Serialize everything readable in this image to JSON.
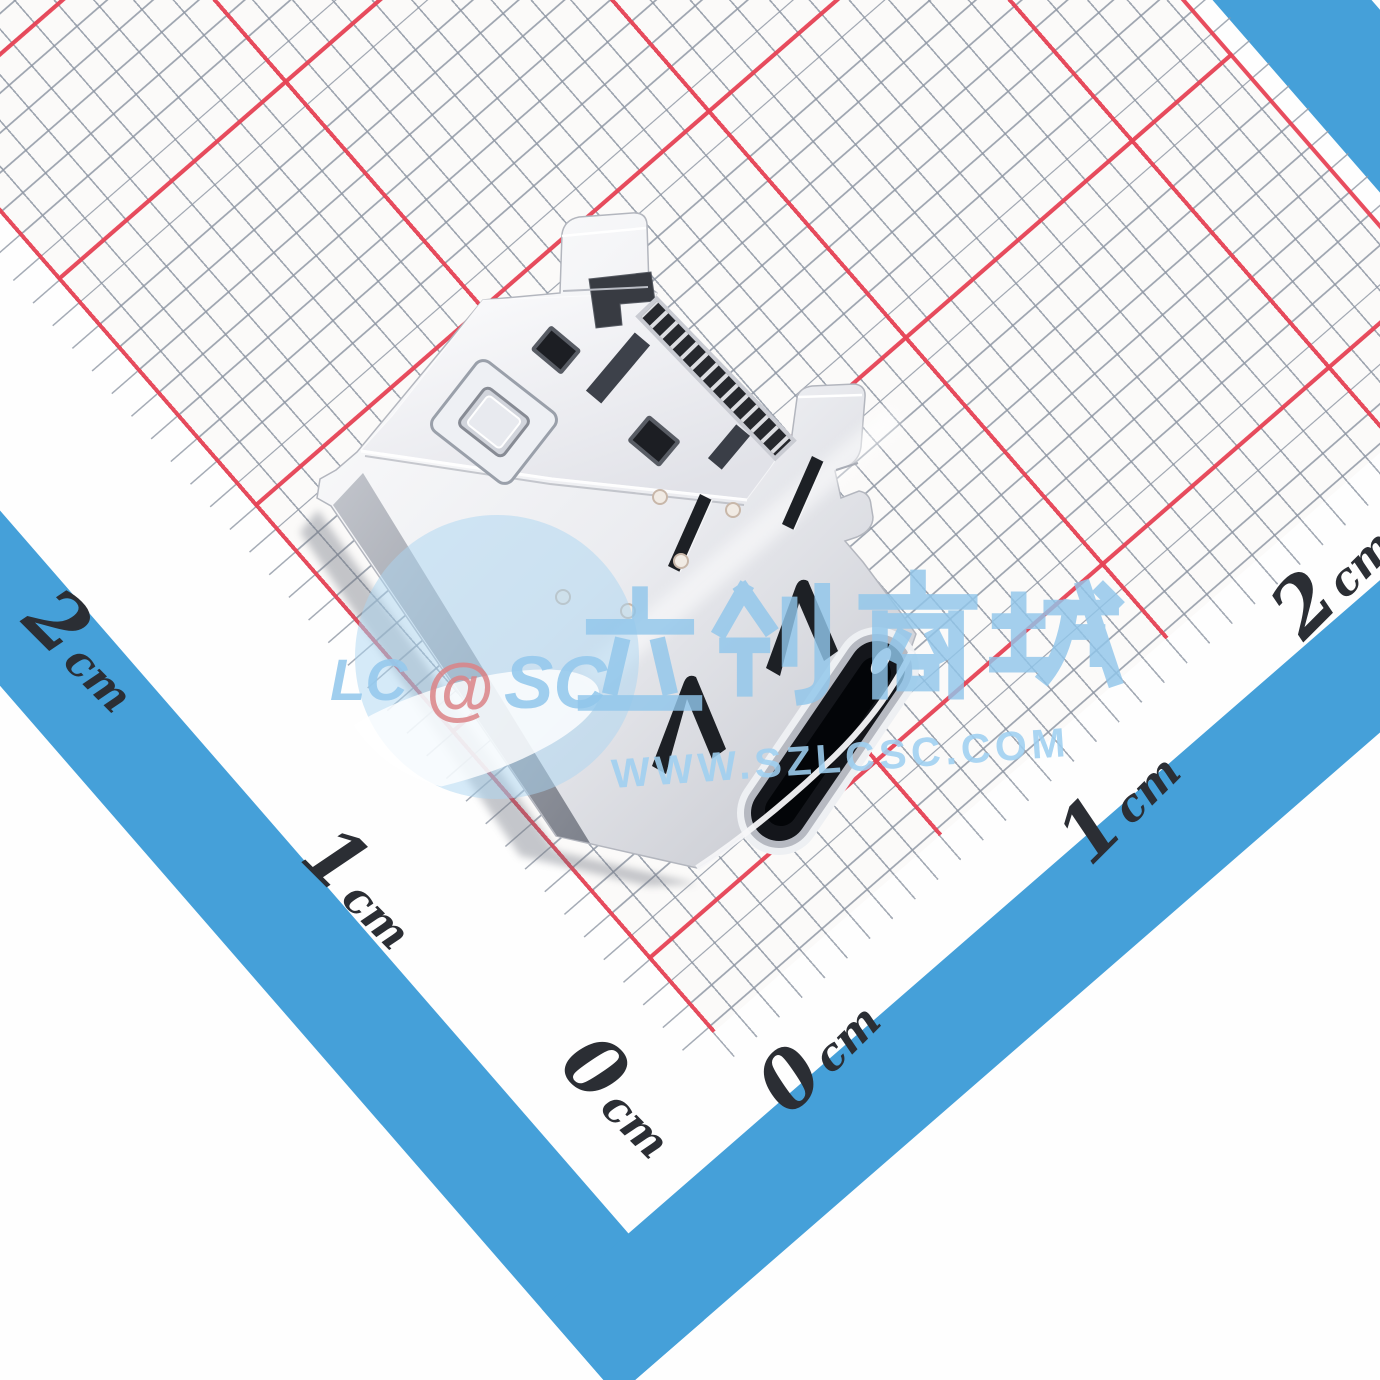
{
  "subject": {
    "type": "usb-type-c-receptacle-connector",
    "surface": "metric-grid-paper-with-blue-border"
  },
  "ruler": {
    "unit": "cm",
    "left_labels": [
      {
        "value": "2"
      },
      {
        "value": "1"
      },
      {
        "value": "0"
      }
    ],
    "right_labels": [
      {
        "value": "0"
      },
      {
        "value": "1"
      },
      {
        "value": "2"
      }
    ]
  },
  "watermark": {
    "brand_left": "LC",
    "brand_at": "@",
    "brand_right": "SC",
    "cn_text": "立创商城",
    "url": "WWW.SZLCSC.COM"
  },
  "colors": {
    "grid_red": "#e74355",
    "grid_gray": "#8f97a4",
    "border_blue": "#45a0d9",
    "paper_white": "#fbfaf9",
    "watermark_blue": "#96c6ea",
    "watermark_at_red": "#db8286",
    "label_ink": "#2b2e34"
  }
}
